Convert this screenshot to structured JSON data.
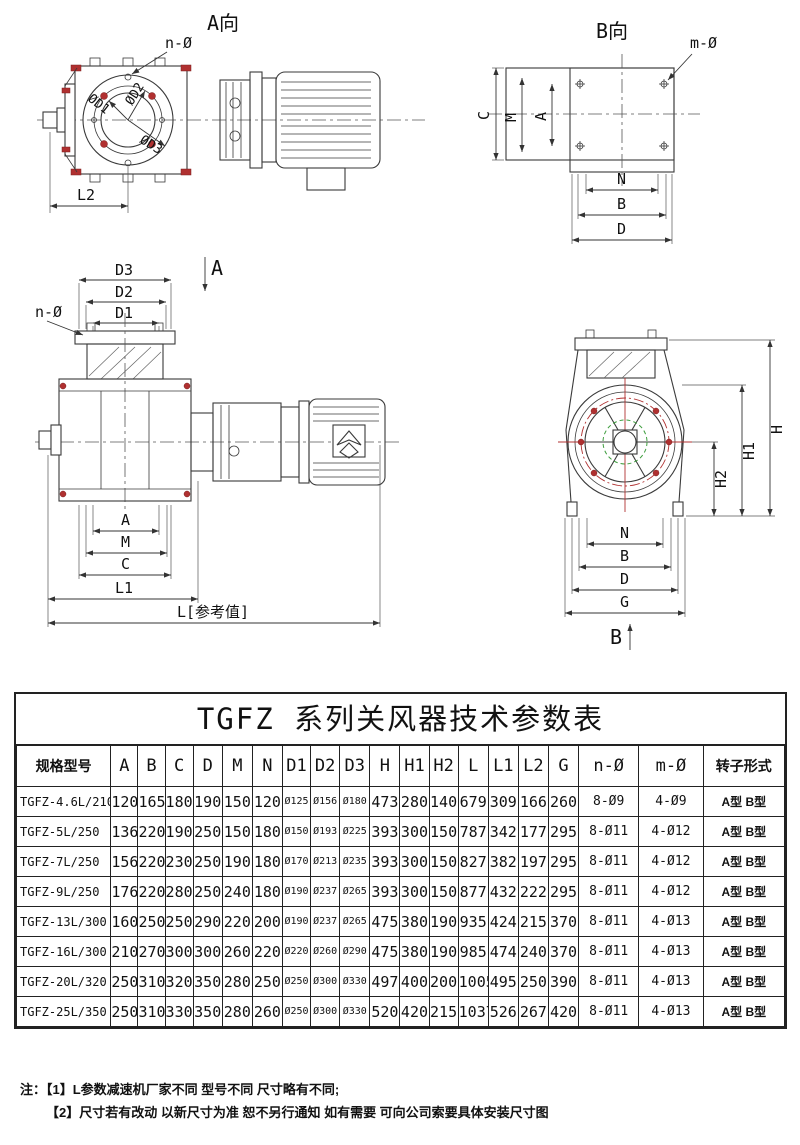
{
  "drawings": {
    "view_a": {
      "title": "A向",
      "n_label": "n-Ø",
      "d1": "ØD1",
      "d2": "ØD2",
      "d3": "ØD3",
      "l2": "L2"
    },
    "view_b": {
      "title": "B向",
      "m_label": "m-Ø",
      "c": "C",
      "m": "M",
      "a": "A",
      "n": "N",
      "b": "B",
      "d": "D"
    },
    "front_view": {
      "d3": "D3",
      "d2": "D2",
      "d1": "D1",
      "n_label": "n-Ø",
      "section": "A",
      "a": "A",
      "m": "M",
      "c": "C",
      "l1": "L1",
      "l_ref": "L[参考值]"
    },
    "side_view": {
      "h": "H",
      "h1": "H1",
      "h2": "H2",
      "n": "N",
      "b": "B",
      "d": "D",
      "g": "G",
      "section": "B"
    }
  },
  "table": {
    "title": "TGFZ 系列关风器技术参数表",
    "columns": [
      "规格型号",
      "A",
      "B",
      "C",
      "D",
      "M",
      "N",
      "D1",
      "D2",
      "D3",
      "H",
      "H1",
      "H2",
      "L",
      "L1",
      "L2",
      "G",
      "n-Ø",
      "m-Ø",
      "转子形式"
    ],
    "rows": [
      [
        "TGFZ-4.6L/210",
        "120",
        "165",
        "180",
        "190",
        "150",
        "120",
        "Ø125",
        "Ø156",
        "Ø180",
        "473",
        "280",
        "140",
        "679",
        "309",
        "166",
        "260",
        "8-Ø9",
        "4-Ø9",
        "A型 B型"
      ],
      [
        "TGFZ-5L/250",
        "136",
        "220",
        "190",
        "250",
        "150",
        "180",
        "Ø150",
        "Ø193",
        "Ø225",
        "393",
        "300",
        "150",
        "787",
        "342",
        "177",
        "295",
        "8-Ø11",
        "4-Ø12",
        "A型 B型"
      ],
      [
        "TGFZ-7L/250",
        "156",
        "220",
        "230",
        "250",
        "190",
        "180",
        "Ø170",
        "Ø213",
        "Ø235",
        "393",
        "300",
        "150",
        "827",
        "382",
        "197",
        "295",
        "8-Ø11",
        "4-Ø12",
        "A型 B型"
      ],
      [
        "TGFZ-9L/250",
        "176",
        "220",
        "280",
        "250",
        "240",
        "180",
        "Ø190",
        "Ø237",
        "Ø265",
        "393",
        "300",
        "150",
        "877",
        "432",
        "222",
        "295",
        "8-Ø11",
        "4-Ø12",
        "A型 B型"
      ],
      [
        "TGFZ-13L/300",
        "160",
        "250",
        "250",
        "290",
        "220",
        "200",
        "Ø190",
        "Ø237",
        "Ø265",
        "475",
        "380",
        "190",
        "935",
        "424",
        "215",
        "370",
        "8-Ø11",
        "4-Ø13",
        "A型 B型"
      ],
      [
        "TGFZ-16L/300",
        "210",
        "270",
        "300",
        "300",
        "260",
        "220",
        "Ø220",
        "Ø260",
        "Ø290",
        "475",
        "380",
        "190",
        "985",
        "474",
        "240",
        "370",
        "8-Ø11",
        "4-Ø13",
        "A型 B型"
      ],
      [
        "TGFZ-20L/320",
        "250",
        "310",
        "320",
        "350",
        "280",
        "250",
        "Ø250",
        "Ø300",
        "Ø330",
        "497",
        "400",
        "200",
        "1005",
        "495",
        "250",
        "390",
        "8-Ø11",
        "4-Ø13",
        "A型 B型"
      ],
      [
        "TGFZ-25L/350",
        "250",
        "310",
        "330",
        "350",
        "280",
        "260",
        "Ø250",
        "Ø300",
        "Ø330",
        "520",
        "420",
        "215",
        "1037",
        "526",
        "267",
        "420",
        "8-Ø11",
        "4-Ø13",
        "A型 B型"
      ]
    ]
  },
  "notes": {
    "prefix": "注：",
    "line1": "【1】L参数减速机厂家不同 型号不同 尺寸略有不同;",
    "line2": "【2】尺寸若有改动 以新尺寸为准 恕不另行通知 如有需要 可向公司索要具体安装尺寸图"
  }
}
